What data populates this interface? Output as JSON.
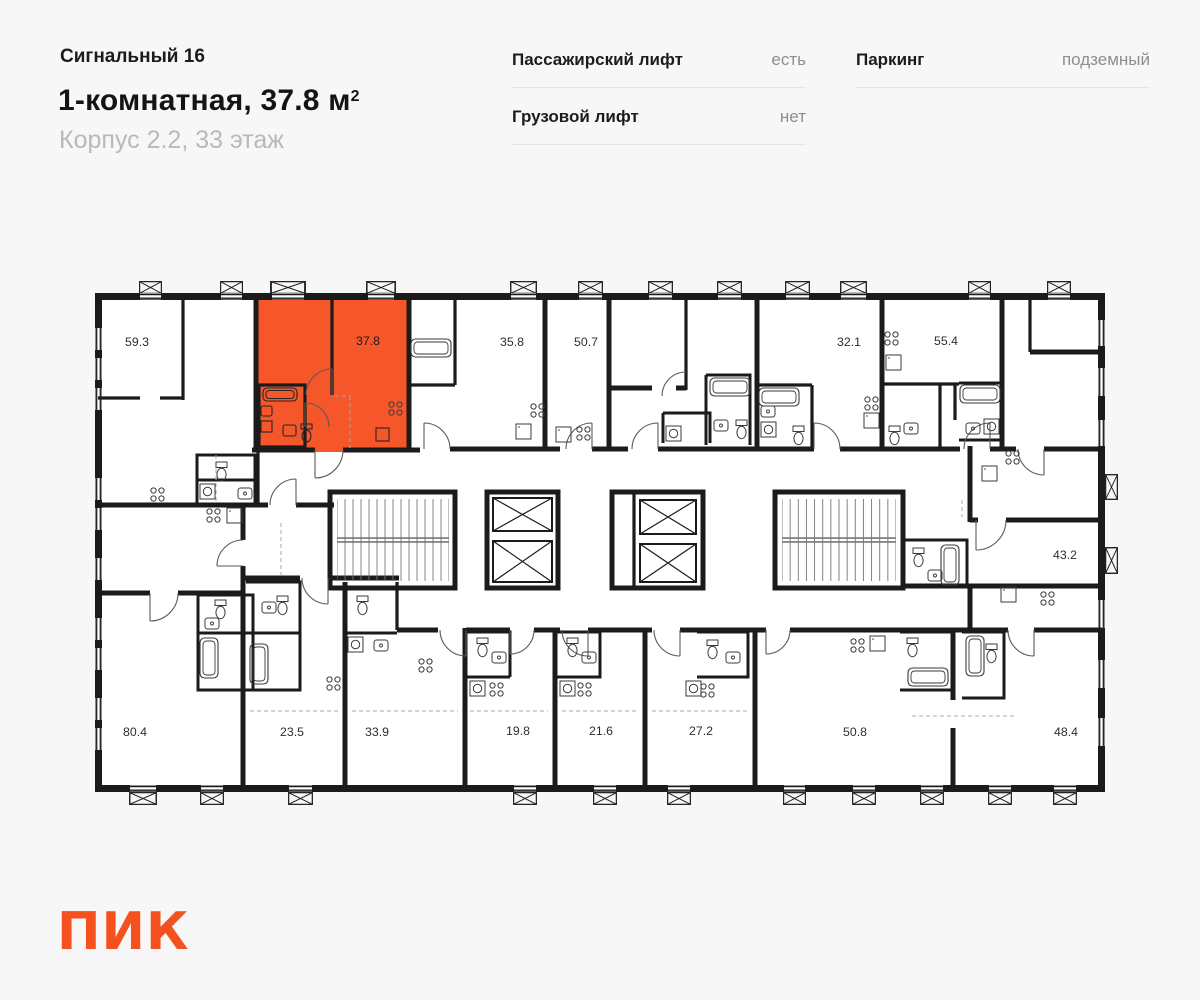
{
  "header": {
    "project_name": "Сигнальный 16",
    "apartment_title": "1-комнатная, 37.8 м",
    "area_superscript": "2",
    "location": "Корпус 2.2, 33 этаж"
  },
  "info": {
    "columns": [
      {
        "rows": [
          {
            "label": "Пассажирский лифт",
            "value": "есть"
          },
          {
            "label": "Грузовой лифт",
            "value": "нет"
          }
        ]
      },
      {
        "rows": [
          {
            "label": "Паркинг",
            "value": "подземный"
          }
        ]
      }
    ]
  },
  "floorplan": {
    "selected_unit": {
      "area": "37.8",
      "highlight_color": "#F5562A"
    },
    "units": [
      {
        "area": "59.3"
      },
      {
        "area": "37.8"
      },
      {
        "area": "35.8"
      },
      {
        "area": "50.7"
      },
      {
        "area": "32.1"
      },
      {
        "area": "55.4"
      },
      {
        "area": "43.2"
      },
      {
        "area": "80.4"
      },
      {
        "area": "23.5"
      },
      {
        "area": "33.9"
      },
      {
        "area": "19.8"
      },
      {
        "area": "21.6"
      },
      {
        "area": "27.2"
      },
      {
        "area": "50.8"
      },
      {
        "area": "48.4"
      }
    ]
  },
  "logo_text": "ПИК",
  "colors": {
    "highlight": "#F5562A",
    "wall": "#1B1B1B",
    "background": "#F7F7F8",
    "logo": "#F4511E",
    "muted_text": "#8E8E8E"
  }
}
